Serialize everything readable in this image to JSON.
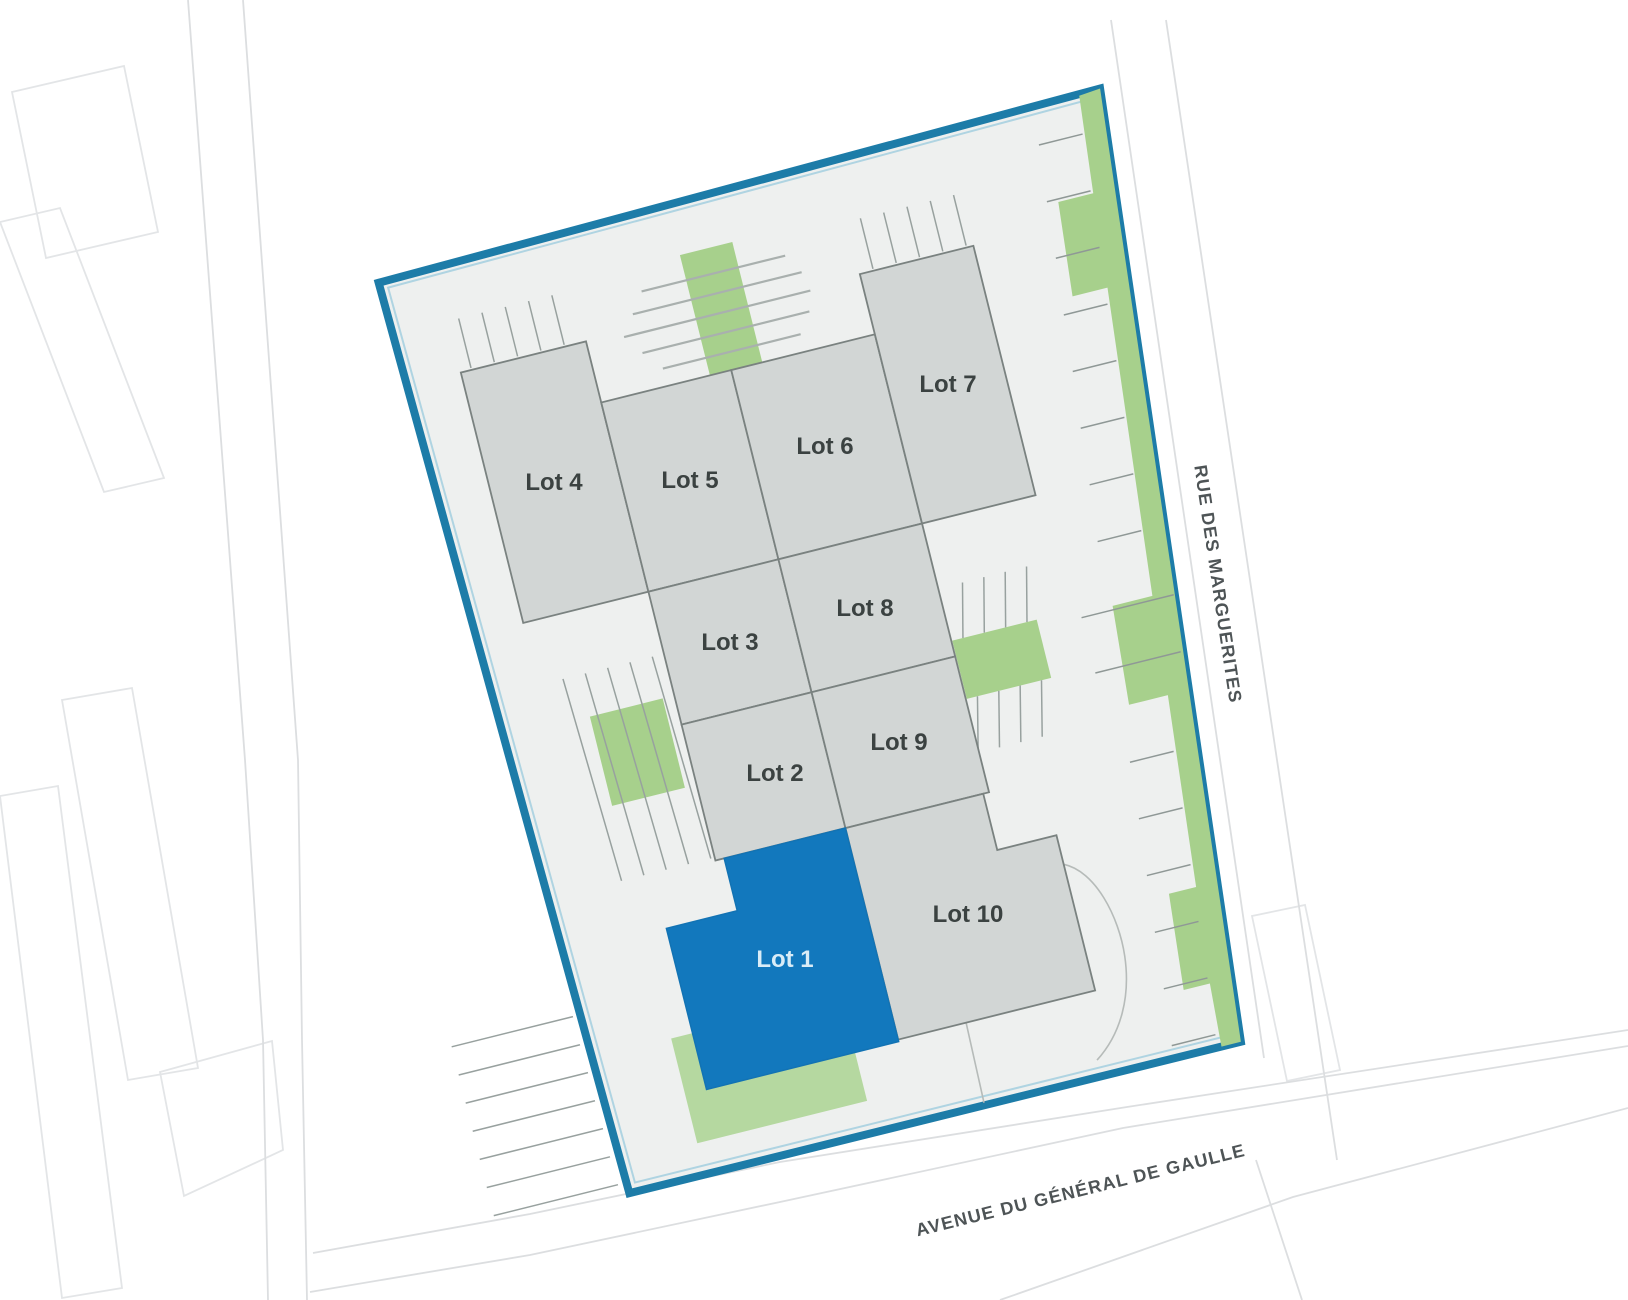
{
  "plan": {
    "lots": [
      {
        "label": "Lot 1",
        "selected": true
      },
      {
        "label": "Lot 2",
        "selected": false
      },
      {
        "label": "Lot 3",
        "selected": false
      },
      {
        "label": "Lot 4",
        "selected": false
      },
      {
        "label": "Lot 5",
        "selected": false
      },
      {
        "label": "Lot 6",
        "selected": false
      },
      {
        "label": "Lot 7",
        "selected": false
      },
      {
        "label": "Lot 8",
        "selected": false
      },
      {
        "label": "Lot 9",
        "selected": false
      },
      {
        "label": "Lot 10",
        "selected": false
      }
    ],
    "streets": {
      "east": "RUE DES MARGUERITES",
      "south": "AVENUE DU GÉNÉRAL DE GAULLE"
    },
    "colors": {
      "selected_lot": "#1278bd",
      "lot_fill": "#d2d6d5",
      "site_fill": "#eef0ef",
      "site_border": "#1d7ca8",
      "green": "#a7d08c",
      "green_light": "#b5d8a0"
    }
  }
}
